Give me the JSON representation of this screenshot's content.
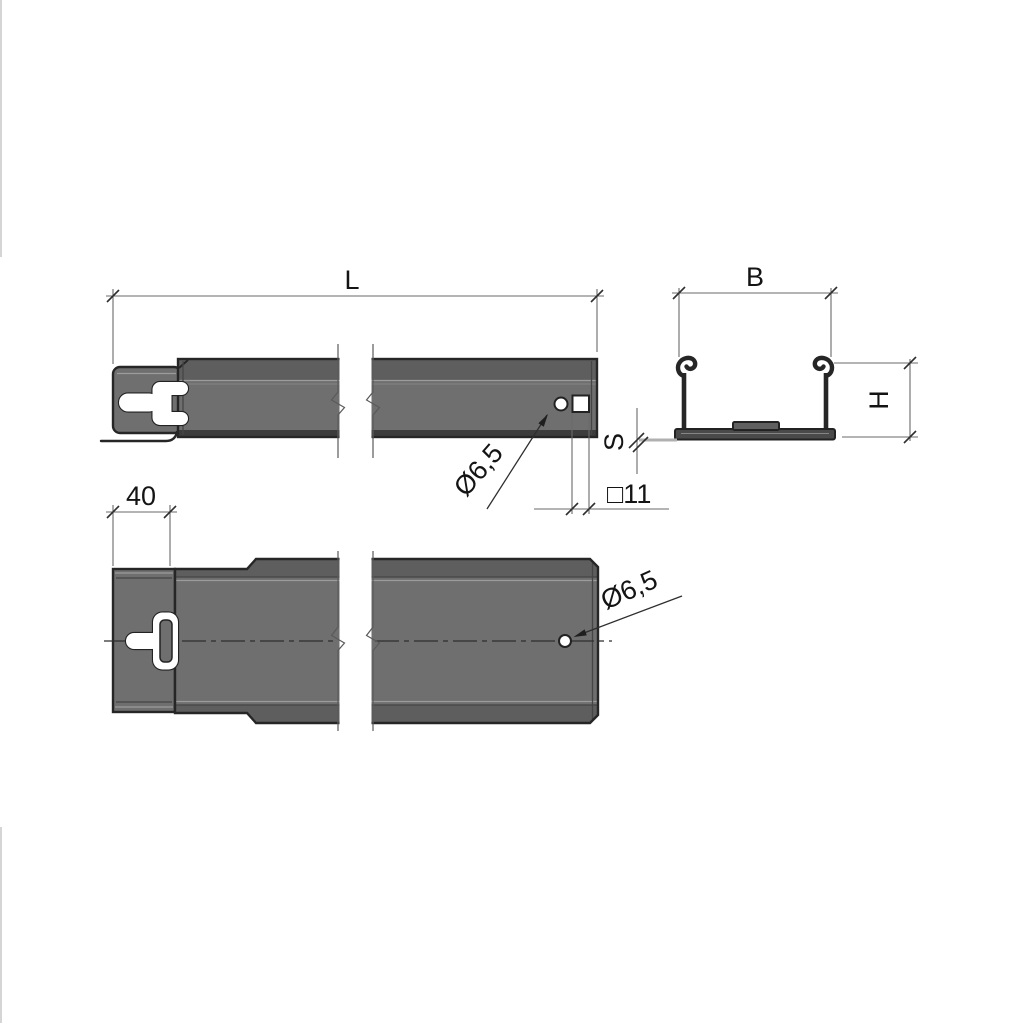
{
  "drawing": {
    "type": "technical-drawing",
    "subject": "C-profile mounting channel with keyhole slot",
    "views": {
      "side": {
        "name": "side-view",
        "length_label": "L",
        "hole_label": "Ø6,5",
        "square_hole_label": "□11"
      },
      "top": {
        "name": "top-view",
        "end_width_label": "40",
        "hole_label": "Ø6,5"
      },
      "section": {
        "name": "cross-section",
        "width_label": "B",
        "height_label": "H",
        "thickness_label": "S"
      }
    },
    "colors": {
      "background": "#ffffff",
      "body_fill": "#6f6f6f",
      "body_band": "#5e5e5e",
      "body_shadow": "#3c3c3c",
      "base_fill": "#4a4a4a",
      "rib_fill": "#5f5f5f",
      "outline": "#262626",
      "dim_line": "#6a6a6a",
      "text": "#141414",
      "ghost_gray": "#b0b0b0"
    }
  }
}
